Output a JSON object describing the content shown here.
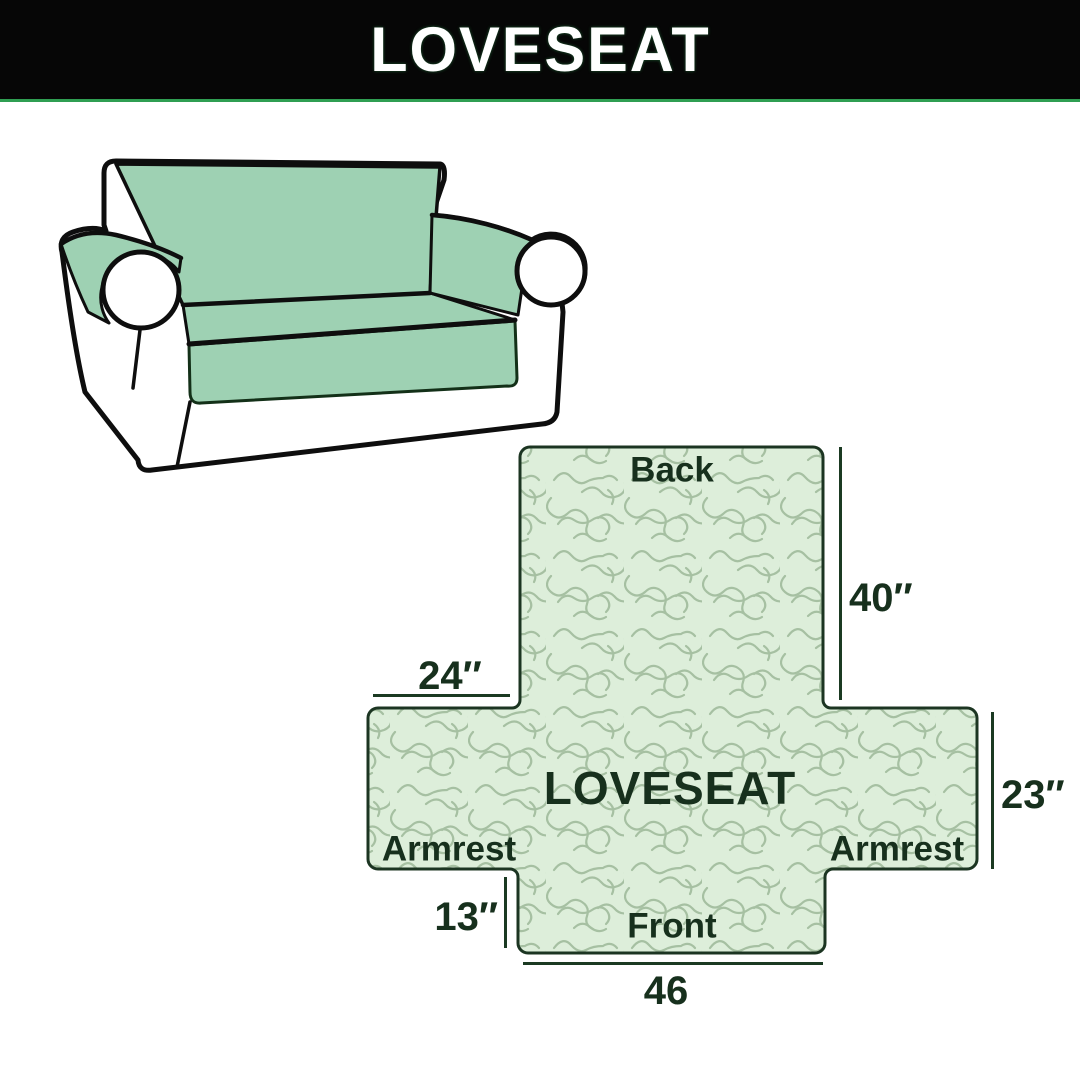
{
  "header": {
    "title": "LOVESEAT",
    "bg_color": "#060606",
    "text_color": "#ffffff",
    "accent_line_color": "#2f9e52"
  },
  "sofa_illustration": {
    "description": "line-art loveseat sofa with mint green slipcover on back, seat and armrests",
    "cover_color": "#9ed1b3",
    "body_color": "#ffffff",
    "outline_color": "#0e0e0e"
  },
  "cover_diagram": {
    "center_label": "LOVESEAT",
    "panel_labels": {
      "back": "Back",
      "front": "Front",
      "armrest_left": "Armrest",
      "armrest_right": "Armrest"
    },
    "dimensions": {
      "back_height": "40″",
      "armrest_top_width": "24″",
      "seat_side_depth": "23″",
      "front_drop": "13″",
      "front_width": "46"
    },
    "colors": {
      "fill": "#ddeeda",
      "squiggle": "#a6c0a2",
      "outline": "#1c3522",
      "text": "#17301d",
      "dimension_line": "#1b3a22"
    }
  }
}
